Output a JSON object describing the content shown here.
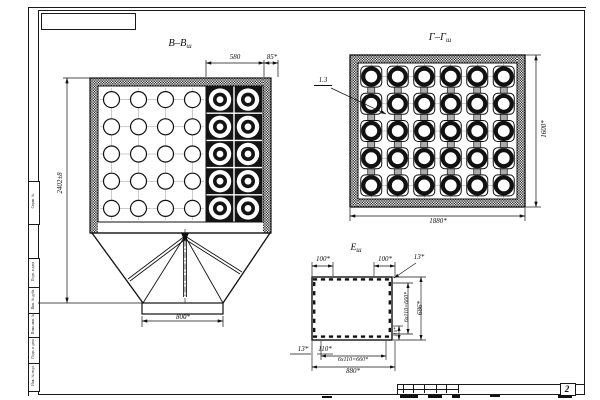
{
  "sheet": {
    "number": "2",
    "stamp_labels": [
      "Справ. №",
      "Подп. и дата",
      "Инв. № дубл.",
      "Взам. инв. №",
      "Подп. и дата",
      "Инв. № подл."
    ]
  },
  "view_b": {
    "title_main": "В–В",
    "title_sub": "ш",
    "dim_tube_bank_width": "580",
    "dim_edge": "85*",
    "dim_height": "2402±8",
    "dim_outlet": "800*",
    "plain_grid": {
      "cols": 4,
      "rows": 5
    },
    "tube_grid": {
      "cols": 2,
      "rows": 5
    }
  },
  "view_g": {
    "title_main": "Г–Г",
    "title_sub": "ш",
    "callout": "1.3",
    "dim_width": "1880*",
    "dim_height": "1600*",
    "grid": {
      "cols": 6,
      "rows": 5
    }
  },
  "view_e": {
    "title_main": "Е",
    "title_sub": "ш",
    "dim_top_left": "100*",
    "dim_top_right": "100*",
    "leader_top_right": "13*",
    "dim_right_pitch": "6х110=660*",
    "dim_right_total": "686*",
    "dim_right_last": "110*",
    "leader_bottom_left": "13*",
    "leader_bottom_offset": "110*",
    "dim_bottom_pitch": "6х110=660*",
    "dim_bottom_total": "880*"
  }
}
